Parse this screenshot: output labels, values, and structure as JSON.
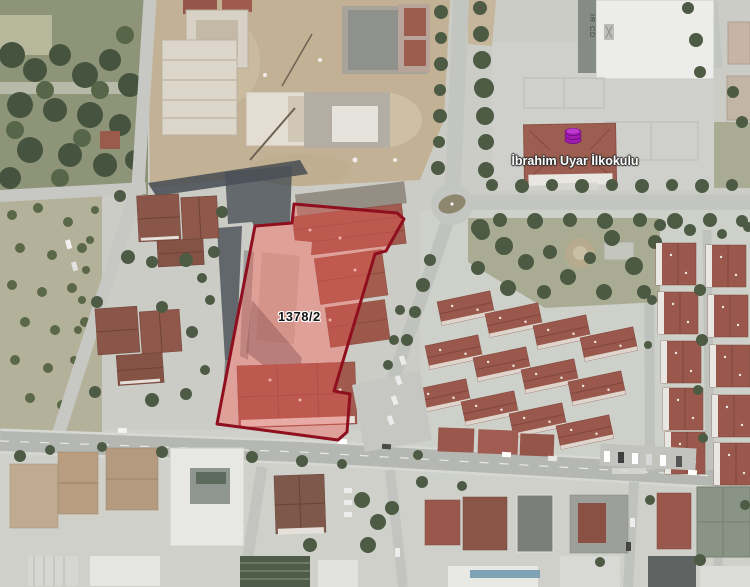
{
  "map": {
    "parcel": {
      "label": "1378/2"
    },
    "school": {
      "label": "İbrahim Uyar İlkokulu"
    },
    "gym_roof_text": "IR CD",
    "colors": {
      "parcel_border": "#8f0f1e",
      "parcel_fill": "rgba(234,88,82,0.40)",
      "poi_icon_fill": "#a21caf",
      "poi_icon_stroke": "#6d0b86",
      "parcel_label_color": "#141414",
      "school_label_color": "#ffffff"
    }
  }
}
